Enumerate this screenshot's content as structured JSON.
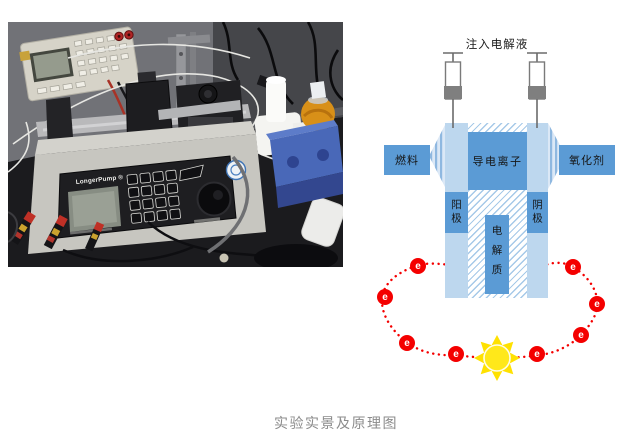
{
  "caption": "实验实景及原理图",
  "photo": {
    "pump_brand": "LongerPump ®"
  },
  "diagram": {
    "title": "注入电解液",
    "fuel": "燃料",
    "oxidant": "氧化剂",
    "conductive_ions": "导电离子",
    "anode": "阳极",
    "cathode": "阴极",
    "electrolyte": "电解质",
    "electron_label": "e",
    "electron_count": 8,
    "colors": {
      "medium_blue": "#5b9bd5",
      "light_blue": "#bdd7ee",
      "hatch_blue": "#a6c9e8",
      "electron_red": "#f40000",
      "sun_yellow": "#ffe100",
      "syringe_gray": "#7f7f7f",
      "caption_gray": "#8b8b8b"
    }
  }
}
